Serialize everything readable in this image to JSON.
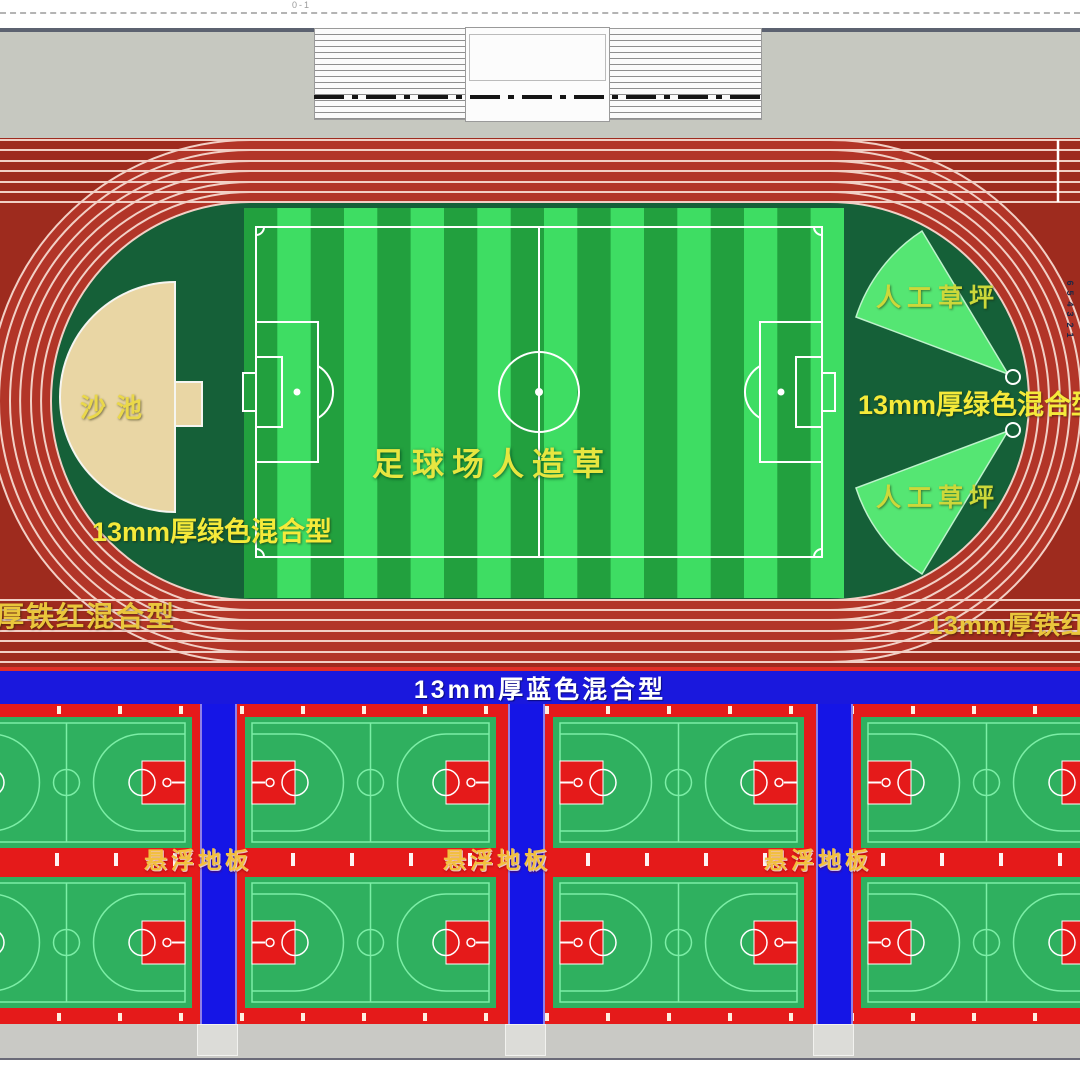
{
  "page": {
    "top_note": "0-1"
  },
  "grandstand": {
    "type": "bleachers"
  },
  "track": {
    "lane_numbers": [
      "6",
      "5",
      "4",
      "3",
      "2",
      "1"
    ],
    "labels": {
      "sand_pit": "沙池",
      "soccer_field": "足球场人造草",
      "turf_top": "人工草坪",
      "turf_bottom": "人工草坪",
      "green_mix_right": "13mm厚绿色混合型",
      "green_mix_left": "13mm厚绿色混合型",
      "iron_red_left": "厚铁红混合型",
      "iron_red_right": "13mm厚铁红"
    }
  },
  "courts_section": {
    "blue_band_label": "13mm厚蓝色混合型",
    "floor_labels": [
      "悬浮地板",
      "悬浮地板",
      "悬浮地板"
    ]
  },
  "colors": {
    "track_lane_red": "#b23528",
    "track_dark_red": "#9e2b1e",
    "lane_line": "#f2d0c6",
    "infield_green": "#156038",
    "turf_light_green": "#3edd63",
    "turf_dark_green": "#22a03e",
    "sand": "#e9d6a4",
    "wedge_green": "#55e673",
    "label_yellow": "#f0e83c",
    "blue_band": "#1a18dd",
    "court_red": "#e51a1a",
    "court_green": "#2fb05f",
    "court_line_green": "#7ceea6",
    "strip_blue": "#1515e6"
  }
}
